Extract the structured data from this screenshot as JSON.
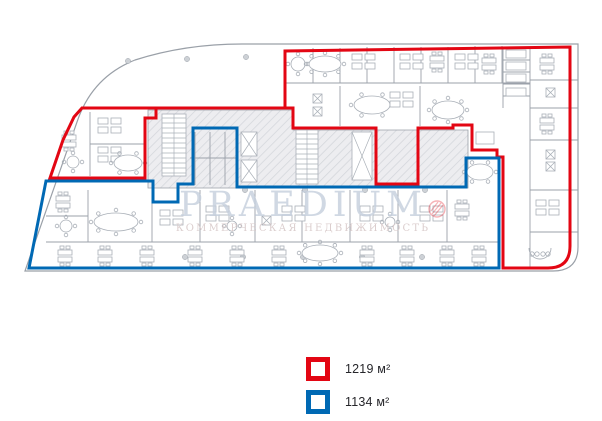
{
  "plan": {
    "watermark": {
      "brand": "PRAEDIUM",
      "tagline": "КОММЕРЧЕСКАЯ НЕДВИЖИМОСТЬ"
    },
    "regions": [
      {
        "id": "red-area",
        "area_label": "1219 м²",
        "outline_color": "#e30613"
      },
      {
        "id": "blue-area",
        "area_label": "1134 м²",
        "outline_color": "#0069b4"
      }
    ]
  },
  "legend": {
    "items": [
      {
        "id": "red-area",
        "label": "1219 м²",
        "color": "#e30613"
      },
      {
        "id": "blue-area",
        "label": "1134 м²",
        "color": "#0069b4"
      }
    ]
  }
}
